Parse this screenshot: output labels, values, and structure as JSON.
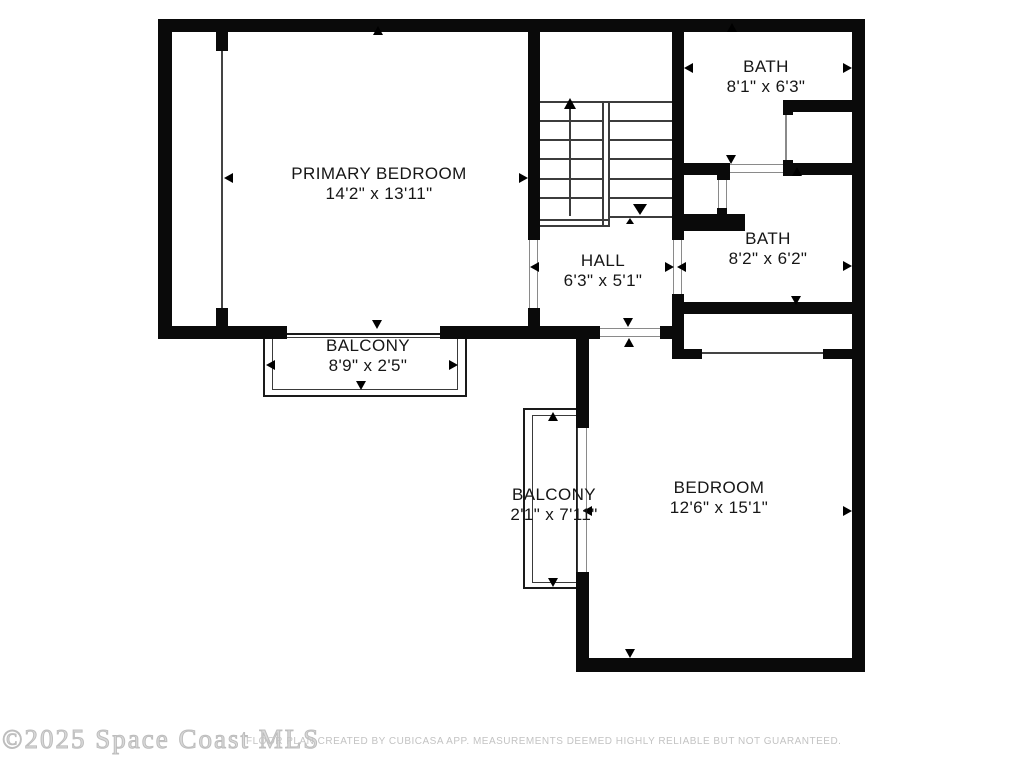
{
  "plan": {
    "title": "Second floor plan",
    "wall_color": "#0a0a0a",
    "background_color": "#ffffff"
  },
  "rooms": {
    "primary_bedroom": {
      "name": "PRIMARY BEDROOM",
      "dimensions": "14'2\" x 13'11\""
    },
    "bath_top": {
      "name": "BATH",
      "dimensions": "8'1\" x 6'3\""
    },
    "bath_middle": {
      "name": "BATH",
      "dimensions": "8'2\" x 6'2\""
    },
    "hall": {
      "name": "HALL",
      "dimensions": "6'3\" x 5'1\""
    },
    "balcony_top": {
      "name": "BALCONY",
      "dimensions": "8'9\" x 2'5\""
    },
    "balcony_bottom": {
      "name": "BALCONY",
      "dimensions": "2'1\" x 7'11\""
    },
    "bedroom": {
      "name": "BEDROOM",
      "dimensions": "12'6\" x 15'1\""
    }
  },
  "footer": {
    "watermark": "©2025 Space Coast MLS",
    "disclaimer": "FLOOR PLAN CREATED BY CUBICASA APP. MEASUREMENTS DEEMED HIGHLY RELIABLE BUT NOT GUARANTEED."
  }
}
